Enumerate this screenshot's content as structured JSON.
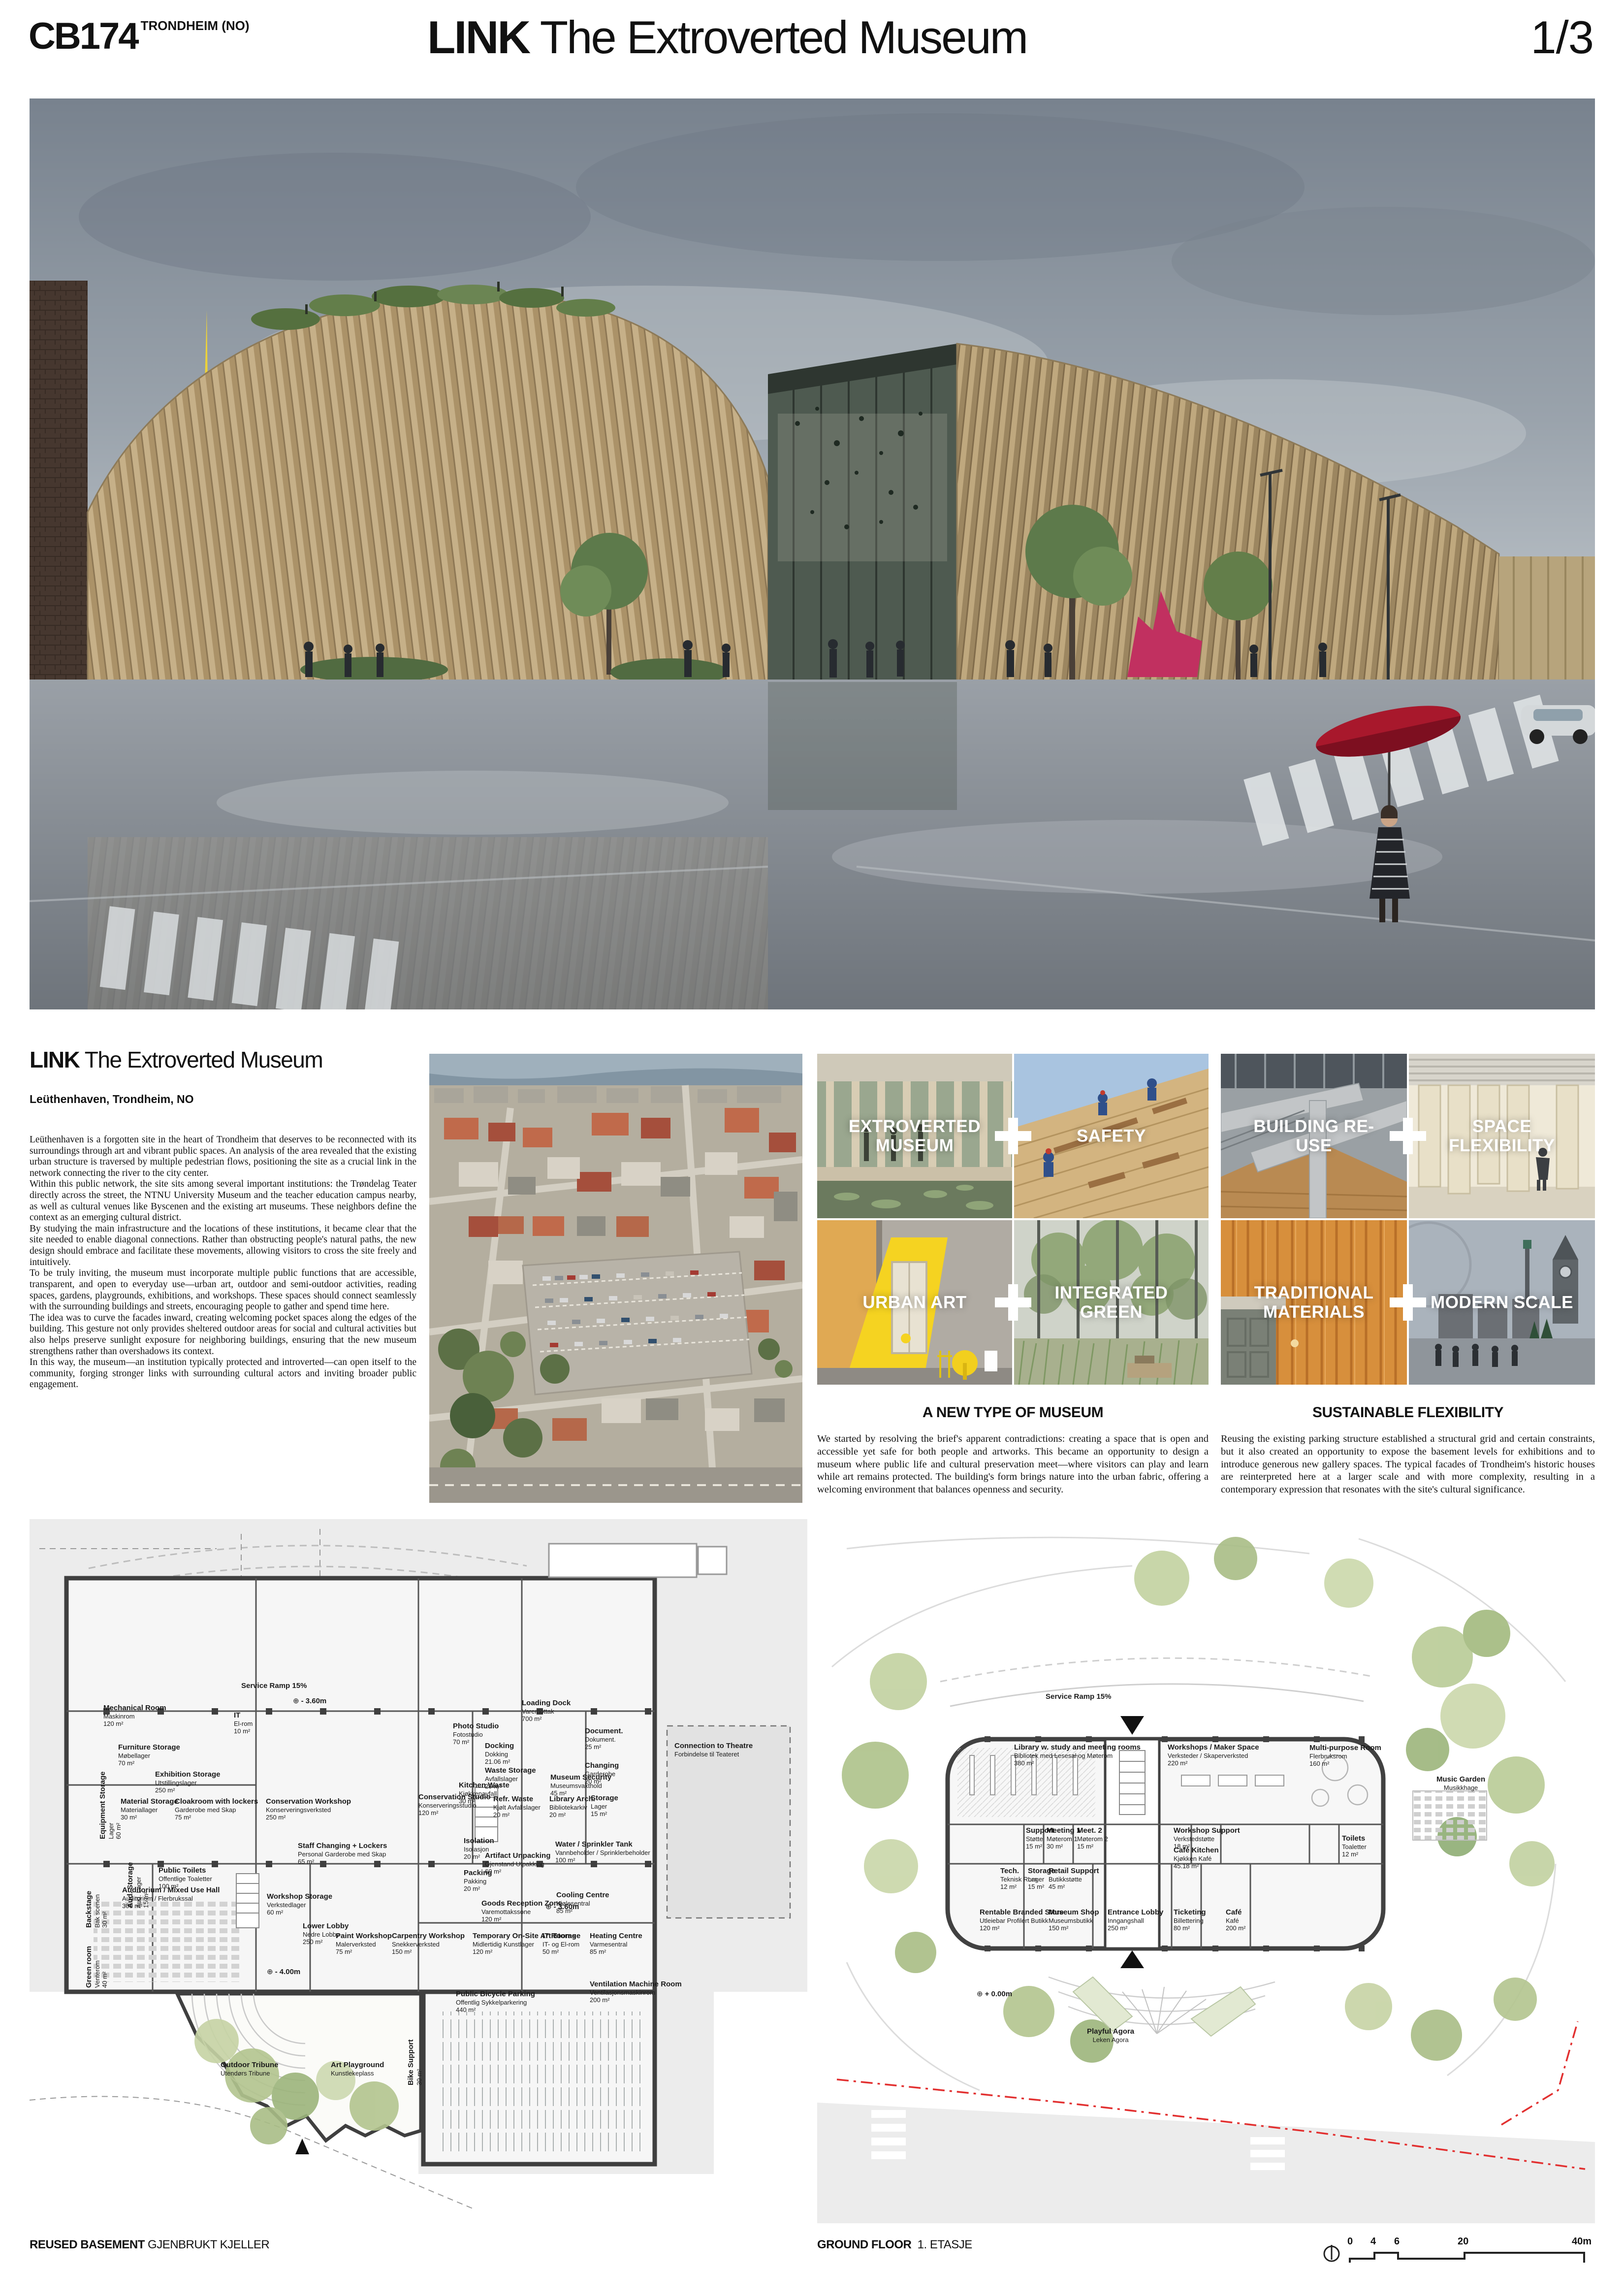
{
  "header": {
    "code": "CB174",
    "location": "TRONDHEIM (NO)",
    "title_bold": "LINK",
    "title_rest": " The Extroverted Museum",
    "page": "1/3"
  },
  "intro": {
    "title_bold": "LINK",
    "title_rest": " The Extroverted Museum",
    "location": "Leüthenhaven, Trondheim, NO",
    "paragraphs": [
      "Leüthenhaven is a forgotten site in the heart of Trondheim that deserves to be reconnected with its surroundings through art and vibrant public spaces. An analysis of the area revealed that the existing urban structure is traversed by multiple pedestrian flows, positioning the site as a crucial link in the network connecting the river to the city center.",
      "Within this public network, the site sits among several important institutions: the Trøndelag Teater directly across the street, the NTNU University Museum and the teacher education campus nearby, as well as cultural venues like Byscenen and the existing art museums. These neighbors define the context as an emerging cultural district.",
      "By studying the main infrastructure and the locations of these institutions, it became clear that the site needed to enable diagonal connections. Rather than obstructing people's natural paths, the new design should embrace and facilitate these movements, allowing visitors to cross the site freely and intuitively.",
      "To be truly inviting, the museum must incorporate multiple public functions that are accessible, transparent, and open to everyday use—urban art, outdoor and semi-outdoor activities, reading spaces, gardens, playgrounds, exhibitions, and workshops. These spaces should connect seamlessly with the surrounding buildings and streets, encouraging people to gather and spend time here.",
      "The idea was to curve the facades inward, creating welcoming pocket spaces along the edges of the building. This gesture not only provides sheltered outdoor areas for social and cultural activities but also helps preserve sunlight exposure for neighboring buildings, ensuring that the new museum strengthens rather than overshadows its context.",
      "In this way, the museum—an institution typically protected and introverted—can open itself to the community, forging stronger links with surrounding cultural actors and inviting broader public engagement."
    ]
  },
  "concepts": {
    "pairs": [
      {
        "a": "EXTROVERTED MUSEUM",
        "b": "SAFETY"
      },
      {
        "a": "URBAN ART",
        "b": "INTEGRATED GREEN"
      },
      {
        "a": "BUILDING RE-USE",
        "b": "SPACE FLEXIBILITY"
      },
      {
        "a": "TRADITIONAL MATERIALS",
        "b": "MODERN SCALE"
      }
    ]
  },
  "sections": [
    {
      "heading": "A NEW TYPE OF MUSEUM",
      "body": "We started by resolving the brief's apparent contradictions: creating a space that is open and accessible yet safe for both people and artworks. This became an opportunity to design a museum where public life and cultural preservation meet—where visitors can play and learn while art remains protected. The building's form brings nature into the urban fabric, offering a welcoming environment that balances openness and security."
    },
    {
      "heading": "SUSTAINABLE FLEXIBILITY",
      "body": "Reusing the existing parking structure established a structural grid and certain constraints, but it also created an opportunity to expose the basement levels for exhibitions and to introduce generous new gallery spaces. The typical facades of Trondheim's historic houses are reinterpreted here at a larger scale and with more complexity, resulting in a contemporary expression that resonates with the site's cultural significance."
    }
  ],
  "plans": {
    "basement": {
      "caption_en": "REUSED BASEMENT",
      "caption_no": "GJENBRUKT KJELLER",
      "rooms": [
        {
          "en": "Mechanical Room",
          "no": "Maskinrom",
          "area": "120 m²"
        },
        {
          "en": "IT",
          "no": "El-rom",
          "area": "10 m²"
        },
        {
          "en": "Furniture Storage",
          "no": "Møbellager",
          "area": "70 m²"
        },
        {
          "en": "Equipment Storage",
          "no": "Lager",
          "area": "60 m²"
        },
        {
          "en": "Exhibition Storage",
          "no": "Utstillingslager",
          "area": "250 m²"
        },
        {
          "en": "Material Storage",
          "no": "Materiallager",
          "area": "30 m²"
        },
        {
          "en": "Cloakroom with lockers",
          "no": "Garderobe med Skap",
          "area": "75 m²"
        },
        {
          "en": "Conservation Workshop",
          "no": "Konserveringsverksted",
          "area": "250 m²"
        },
        {
          "en": "Photo Studio",
          "no": "Fotostudio",
          "area": "70 m²"
        },
        {
          "en": "Docking",
          "no": "Dokking",
          "area": "21.06 m²"
        },
        {
          "en": "Waste Storage",
          "no": "Avfallslager",
          "area": "25 m²"
        },
        {
          "en": "Kitchen Waste",
          "no": "Kjøkkenavfall",
          "area": "30 m²"
        },
        {
          "en": "Refr. Waste",
          "no": "Kjølt Avfallslager",
          "area": "20 m²"
        },
        {
          "en": "Conservation Studio",
          "no": "Konserveringsstudio",
          "area": "120 m²"
        },
        {
          "en": "Loading Dock",
          "no": "Varemottak",
          "area": "700 m²"
        },
        {
          "en": "Document.",
          "no": "Dokument.",
          "area": "25 m²"
        },
        {
          "en": "Changing",
          "no": "Garderobe",
          "area": "20 m²"
        },
        {
          "en": "Museum Security",
          "no": "Museumsvakthold",
          "area": "45 m²"
        },
        {
          "en": "Library Arch.",
          "no": "Bibliotekarkiv",
          "area": "20 m²"
        },
        {
          "en": "Storage",
          "no": "Lager",
          "area": "15 m²"
        },
        {
          "en": "Isolation",
          "no": "Isolasjon",
          "area": "20 m²"
        },
        {
          "en": "Artifact Unpacking",
          "no": "Gjenstand Utpakking",
          "area": "60 m²"
        },
        {
          "en": "Packing",
          "no": "Pakking",
          "area": "20 m²"
        },
        {
          "en": "Water / Sprinkler Tank",
          "no": "Vannbeholder / Sprinklerbeholder",
          "area": "100 m²"
        },
        {
          "en": "Cooling Centre",
          "no": "Kjølesentral",
          "area": "85 m²"
        },
        {
          "en": "Staff Changing + Lockers",
          "no": "Personal Garderobe med Skap",
          "area": "65 m²"
        },
        {
          "en": "Workshop Storage",
          "no": "Verkstedlager",
          "area": "60 m²"
        },
        {
          "en": "Auditorium / Mixed Use Hall",
          "no": "Auditorium / Flerbrukssal",
          "area": "300 m²"
        },
        {
          "en": "Green room",
          "no": "Venterom",
          "area": "40 m²"
        },
        {
          "en": "Backstage",
          "no": "Bak scenen",
          "area": "30 m²"
        },
        {
          "en": "Aud. Storage",
          "no": "Aud. Lager",
          "area": "15 m²"
        },
        {
          "en": "Public Toilets",
          "no": "Offentlige Toaletter",
          "area": "100 m²"
        },
        {
          "en": "Lower Lobby",
          "no": "Nedre Lobby",
          "area": "250 m²"
        },
        {
          "en": "Paint Workshop",
          "no": "Malerverksted",
          "area": "75 m²"
        },
        {
          "en": "Carpentry Workshop",
          "no": "Snekkerverksted",
          "area": "150 m²"
        },
        {
          "en": "Temporary On-Site Art Storage",
          "no": "Midlertidig Kunstlager",
          "area": "120 m²"
        },
        {
          "en": "IT Rooms",
          "no": "IT- og El-rom",
          "area": "50 m²"
        },
        {
          "en": "Heating Centre",
          "no": "Varmesentral",
          "area": "85 m²"
        },
        {
          "en": "Goods Reception Zone",
          "no": "Varemottakssone",
          "area": "120 m²"
        },
        {
          "en": "Ventilation Machine Room",
          "no": "Ventilasjonsmaskinrom",
          "area": "200 m²"
        },
        {
          "en": "Public Bicycle Parking",
          "no": "Offentlig Sykkelparkering",
          "area": "440 m²"
        },
        {
          "en": "Bike Support",
          "no": "",
          "area": "30 m²"
        }
      ],
      "annotations": [
        {
          "en": "Service Ramp 15%",
          "no": ""
        },
        {
          "en": "Outdoor Tribune",
          "no": "Utendørs Tribune"
        },
        {
          "en": "Art Playground",
          "no": "Kunstlekeplass"
        },
        {
          "en": "Connection to Theatre",
          "no": "Forbindelse til Teateret"
        }
      ],
      "levels": [
        "- 3.60m",
        "- 3.60m",
        "- 4.00m"
      ]
    },
    "ground": {
      "caption_en": "GROUND FLOOR",
      "caption_no": "1. ETASJE",
      "rooms": [
        {
          "en": "Library w. study and meeting rooms",
          "no": "Bibliotek med Lesesal og Møterom",
          "area": "380 m²"
        },
        {
          "en": "Workshops / Maker Space",
          "no": "Verksteder / Skaperverksted",
          "area": "220 m²"
        },
        {
          "en": "Multi-purpose Room",
          "no": "Flerbruksrom",
          "area": "160 m²"
        },
        {
          "en": "Support",
          "no": "Støtte",
          "area": "15 m²"
        },
        {
          "en": "Meeting 1",
          "no": "Møterom 1",
          "area": "30 m²"
        },
        {
          "en": "Meet. 2",
          "no": "Møterom 2",
          "area": "15 m²"
        },
        {
          "en": "Workshop Support",
          "no": "Verkstedstøtte",
          "area": "18 m²"
        },
        {
          "en": "Café Kitchen",
          "no": "Kjøkken Kafé",
          "area": "45.18 m²"
        },
        {
          "en": "Tech.",
          "no": "Teknisk Rom",
          "area": "12 m²"
        },
        {
          "en": "Storage",
          "no": "Lager",
          "area": "15 m²"
        },
        {
          "en": "Retail Support",
          "no": "Butikkstøtte",
          "area": "45 m²"
        },
        {
          "en": "Toilets",
          "no": "Toaletter",
          "area": "12 m²"
        },
        {
          "en": "Rentable Branded Store",
          "no": "Utleiebar Profilert Butikk",
          "area": "120 m²"
        },
        {
          "en": "Museum Shop",
          "no": "Museumsbutikk",
          "area": "150 m²"
        },
        {
          "en": "Entrance Lobby",
          "no": "Inngangshall",
          "area": "250 m²"
        },
        {
          "en": "Ticketing",
          "no": "Billettering",
          "area": "80 m²"
        },
        {
          "en": "Café",
          "no": "Kafé",
          "area": "200 m²"
        }
      ],
      "annotations": [
        {
          "en": "Music Garden",
          "no": "Musikkhage"
        },
        {
          "en": "Playful Agora",
          "no": "Leken Agora"
        },
        {
          "en": "Service Ramp 15%",
          "no": ""
        }
      ],
      "levels": [
        "+ 0.00m"
      ]
    }
  },
  "scalebar": {
    "ticks": [
      "0",
      "4",
      "6",
      "20",
      "40m"
    ]
  },
  "colors": {
    "plan_boundary_red": "#e23030",
    "facade_wood": "#c6b088",
    "umbrella_red": "#a8182c"
  }
}
